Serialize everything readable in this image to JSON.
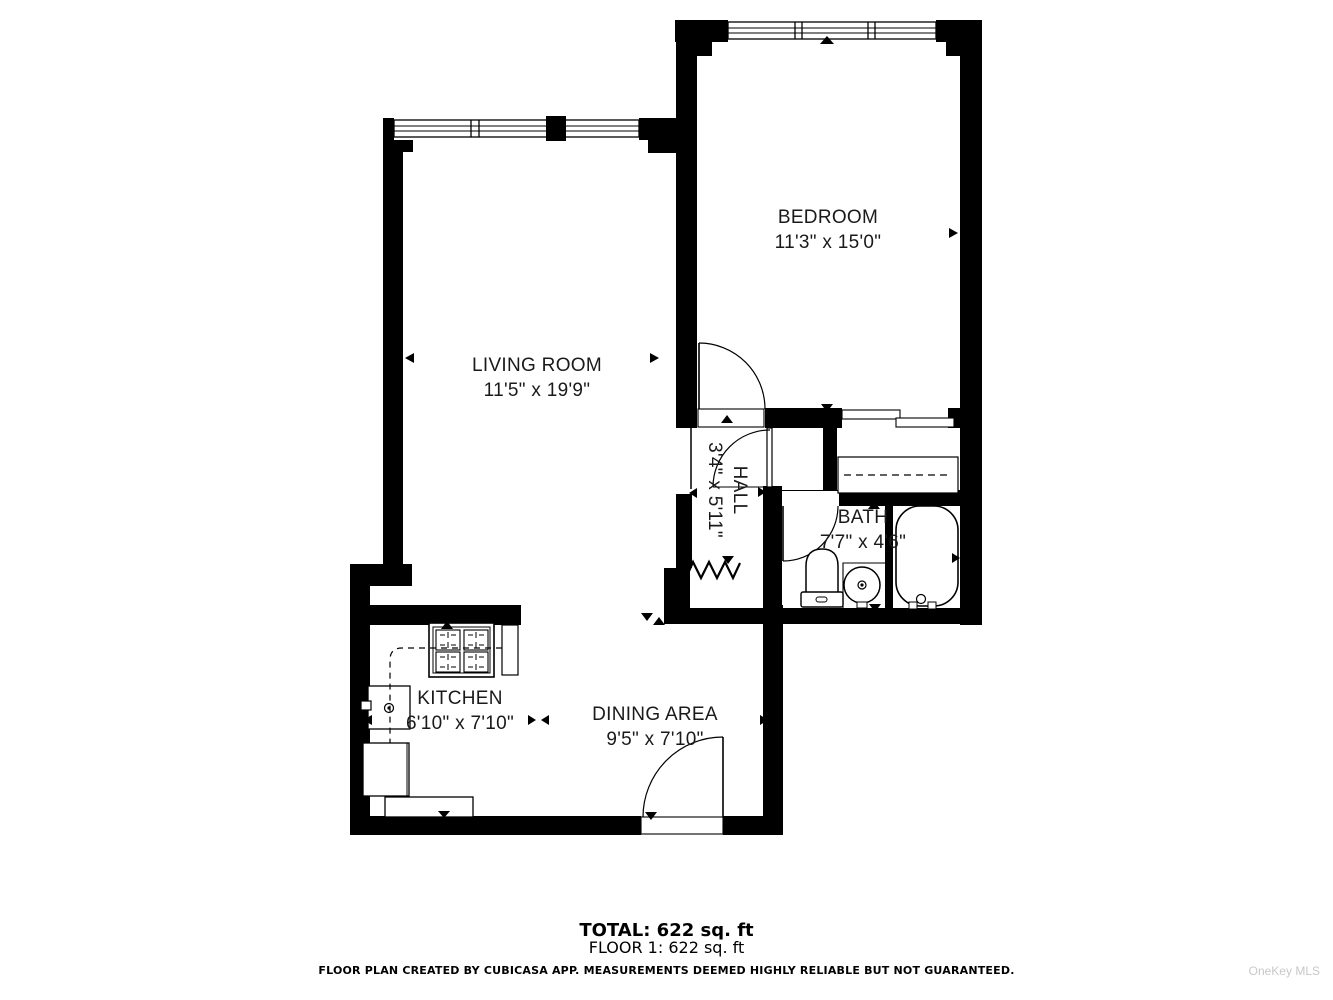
{
  "floorplan": {
    "rooms": [
      {
        "id": "bedroom",
        "name": "BEDROOM",
        "dimensions": "11'3\" x 15'0\""
      },
      {
        "id": "living-room",
        "name": "LIVING ROOM",
        "dimensions": "11'5\" x 19'9\""
      },
      {
        "id": "hall",
        "name": "HALL",
        "dimensions": "3'4\" x 5'11\""
      },
      {
        "id": "bath",
        "name": "BATH",
        "dimensions": "7'7\" x 4'6\""
      },
      {
        "id": "kitchen",
        "name": "KITCHEN",
        "dimensions": "6'10\" x 7'10\""
      },
      {
        "id": "dining-area",
        "name": "DINING AREA",
        "dimensions": "9'5\" x 7'10\""
      }
    ],
    "summary": {
      "total": "TOTAL: 622 sq. ft",
      "floor1": "FLOOR 1: 622 sq. ft"
    },
    "disclaimer": "FLOOR PLAN CREATED BY CUBICASA APP. MEASUREMENTS DEEMED HIGHLY RELIABLE BUT NOT GUARANTEED.",
    "watermark": "OneKey MLS",
    "colors": {
      "wall": "#000000",
      "background": "#ffffff",
      "watermark_gray": "#c8c8c8"
    }
  }
}
